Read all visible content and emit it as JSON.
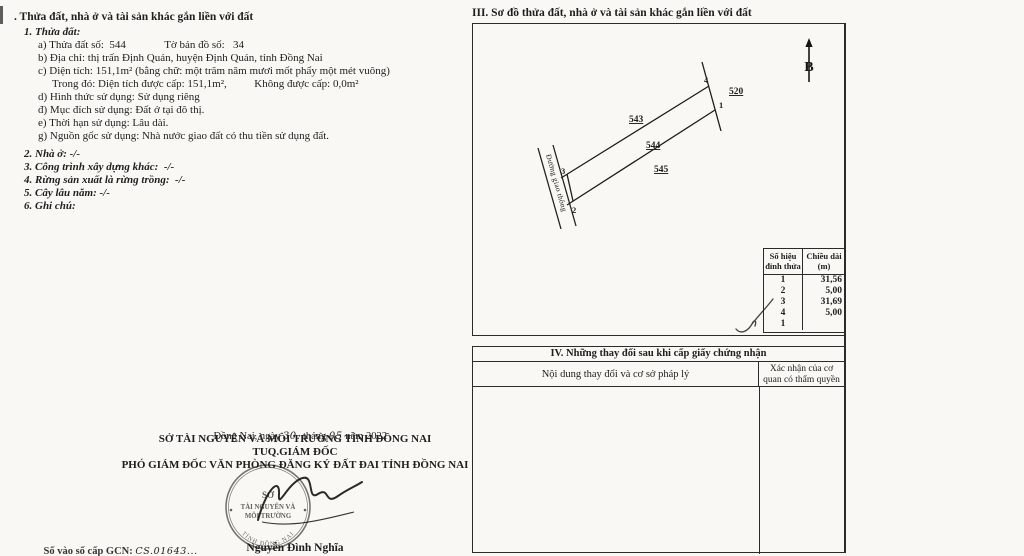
{
  "doc": {
    "section2": {
      "heading": ". Thửa đất, nhà ở và tài sản khác gắn liền với đất",
      "item1": "1. Thửa đất:",
      "line_a": "a) Thửa đất số:  544              Tờ bản đồ số:   34",
      "line_b": "b) Địa chỉ: thị trấn Định Quán, huyện Định Quán, tỉnh Đồng Nai",
      "line_c": "c) Diện tích: 151,1m² (bằng chữ: một trăm năm mươi mốt phẩy một mét vuông)",
      "line_c2": "Trong đó: Diện tích được cấp: 151,1m²,          Không được cấp: 0,0m²",
      "line_d": "d) Hình thức sử dụng: Sử dụng riêng",
      "line_dd": "đ) Mục đích sử dụng: Đất ở tại đô thị.",
      "line_e": "e) Thời hạn sử dụng: Lâu dài.",
      "line_g": "g) Nguồn gốc sử dụng: Nhà nước giao đất có thu tiền sử dụng đất.",
      "item2": "2. Nhà ở: -/-",
      "item3": "3. Công trình xây dựng khác:  -/-",
      "item4": "4. Rừng sản xuất là rừng trồng:  -/-",
      "item5": "5. Cây lâu năm: -/-",
      "item6": "6. Ghi chú:"
    },
    "section3": {
      "title": "III. Sơ đồ thửa đất, nhà ở và tài sản khác gắn liền với đất",
      "north_label": "B",
      "plot_main": "544",
      "plot_top": "543",
      "plot_bottom": "545",
      "plot_right": "520",
      "vertex_1": "1",
      "vertex_2": "2",
      "vertex_3": "3",
      "vertex_4": "4",
      "road_label": "Đường giao thông",
      "table": {
        "col1_header_line1": "Số hiệu",
        "col1_header_line2": "đỉnh thửa",
        "col2_header_line1": "Chiều dài",
        "col2_header_line2": "(m)",
        "rows": [
          {
            "vertex": "1",
            "length": "31,56"
          },
          {
            "vertex": "2",
            "length": "5,00"
          },
          {
            "vertex": "3",
            "length": "31,69"
          },
          {
            "vertex": "4",
            "length": "5,00"
          },
          {
            "vertex": "1",
            "length": ""
          }
        ]
      }
    },
    "section4": {
      "title": "IV. Những thay đổi sau khi cấp giấy chứng nhận",
      "col1_header": "Nội dung thay đổi và cơ sở pháp lý",
      "col2_header_line1": "Xác nhận của cơ",
      "col2_header_line2": "quan có thẩm quyền"
    },
    "signature": {
      "date_prefix": "Đồng Nai, ngày ",
      "date_day": "30.",
      "date_mid": " tháng ",
      "date_month": "05",
      "date_suffix": " năm 2022",
      "org": "SỞ TÀI NGUYÊN VÀ MÔI TRƯỜNG TỈNH ĐỒNG NAI",
      "tuq": "TUQ.GIÁM ĐỐC",
      "role": "PHÓ GIÁM ĐỐC VĂN PHÒNG ĐĂNG KÝ ĐẤT ĐAI TỈNH ĐỒNG NAI",
      "signer": "Nguyễn Đình Nghĩa",
      "stamp_line1": "SỞ",
      "stamp_line2": "TÀI NGUYÊN VÀ",
      "stamp_line3": "MÔI TRƯỜNG",
      "stamp_arc": "TỈNH ĐỒNG NAI",
      "gcn_label": "Số vào sổ cấp GCN: ",
      "gcn_value": "CS.01643..."
    }
  }
}
